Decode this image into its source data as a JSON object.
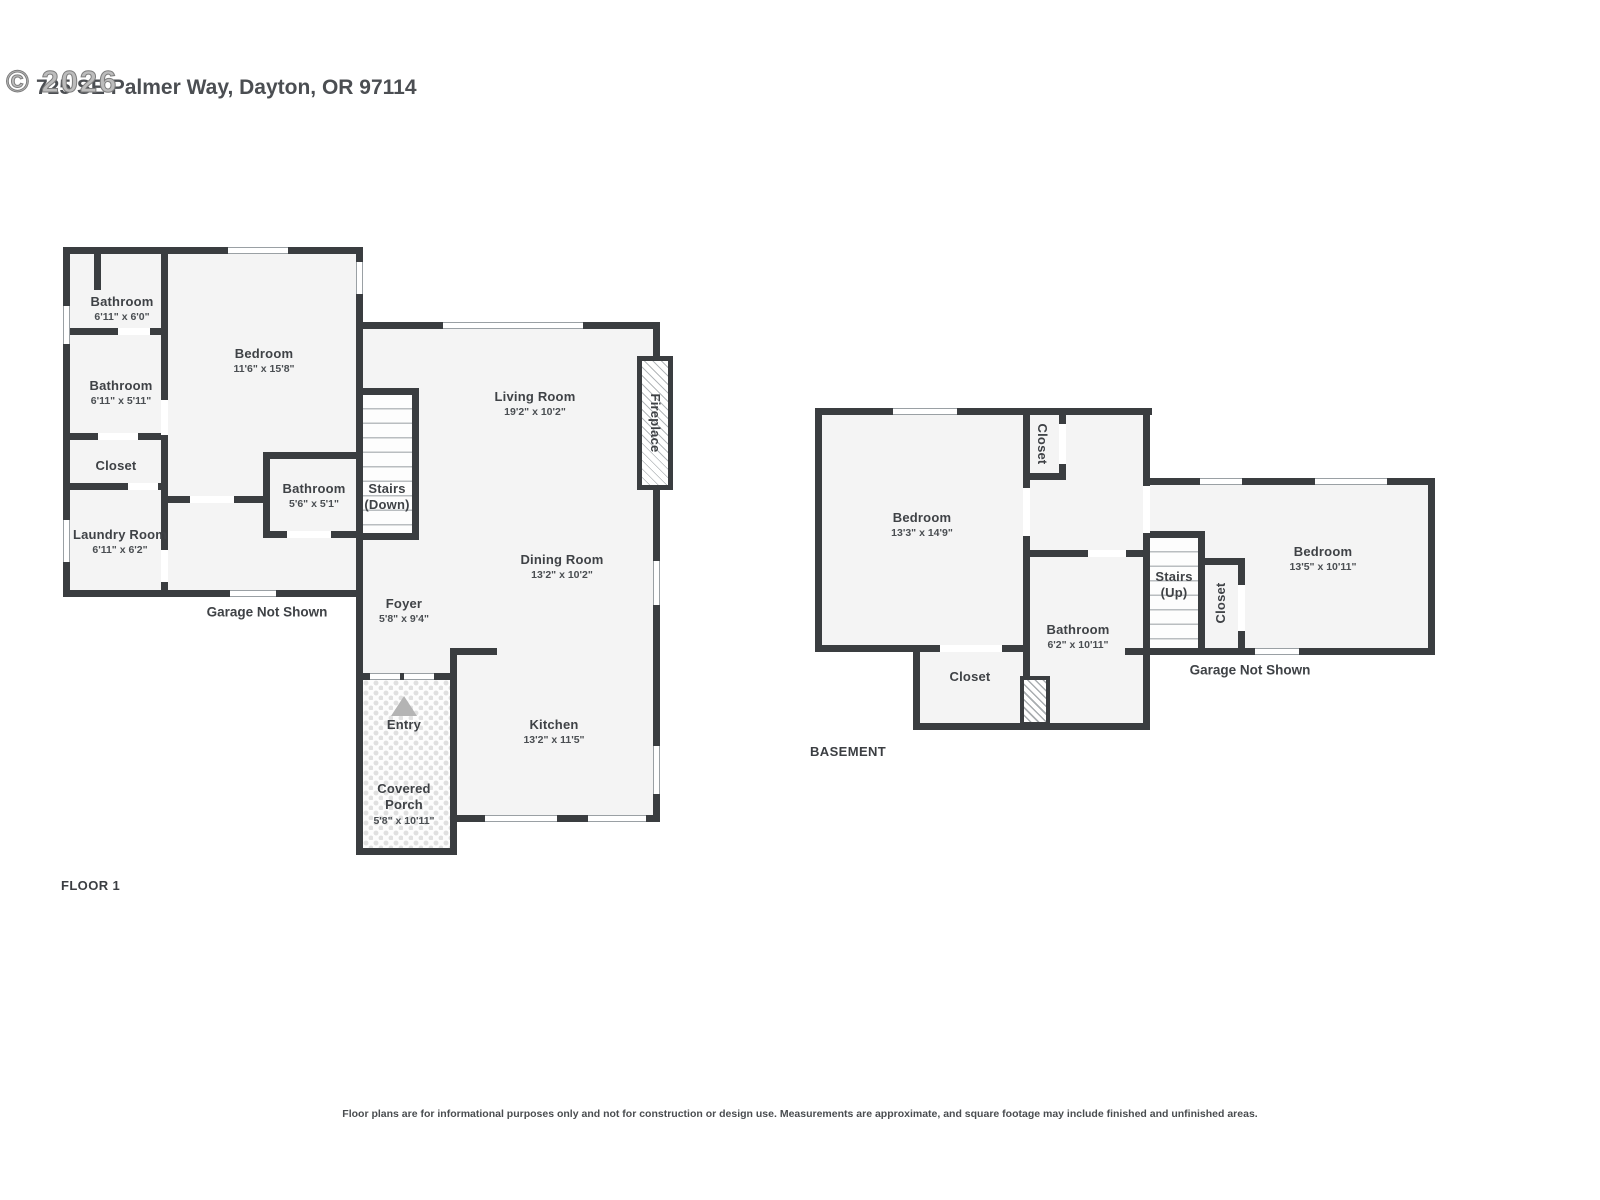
{
  "meta": {
    "colors": {
      "wall": "#3a3d40",
      "room_fill": "#f4f4f4",
      "text": "#3f4246",
      "watermark": "#8f8f8f",
      "entry_arrow": "#b4b4b4"
    }
  },
  "header": {
    "watermark": "© 2026",
    "address": "725 SE Palmer Way, Dayton, OR 97114"
  },
  "floor1": {
    "floor_label": "FLOOR 1",
    "garage_note": "Garage Not Shown",
    "rooms": {
      "bathroom_a": {
        "name": "Bathroom",
        "dims": "6'11\" x 6'0\""
      },
      "bathroom_b": {
        "name": "Bathroom",
        "dims": "6'11\" x 5'11\""
      },
      "closet": {
        "name": "Closet"
      },
      "laundry": {
        "name": "Laundry Room",
        "dims": "6'11\" x 6'2\""
      },
      "bedroom": {
        "name": "Bedroom",
        "dims": "11'6\" x 15'8\""
      },
      "bathroom_c": {
        "name": "Bathroom",
        "dims": "5'6\" x 5'1\""
      },
      "stairs": {
        "name": "Stairs",
        "sub": "(Down)"
      },
      "living_room": {
        "name": "Living Room",
        "dims": "19'2\" x 10'2\""
      },
      "dining_room": {
        "name": "Dining Room",
        "dims": "13'2\" x 10'2\""
      },
      "foyer": {
        "name": "Foyer",
        "dims": "5'8\" x 9'4\""
      },
      "kitchen": {
        "name": "Kitchen",
        "dims": "13'2\" x 11'5\""
      },
      "entry": {
        "name": "Entry"
      },
      "covered_porch": {
        "name": "Covered Porch",
        "dims": "5'8\" x 10'11\""
      },
      "fireplace": {
        "name": "Fireplace"
      }
    }
  },
  "basement": {
    "floor_label": "BASEMENT",
    "garage_note": "Garage Not Shown",
    "rooms": {
      "bedroom_a": {
        "name": "Bedroom",
        "dims": "13'3\" x 14'9\""
      },
      "closet_top": {
        "name": "Closet"
      },
      "bathroom": {
        "name": "Bathroom",
        "dims": "6'2\" x 10'11\""
      },
      "closet_bottom": {
        "name": "Closet"
      },
      "stairs": {
        "name": "Stairs",
        "sub": "(Up)"
      },
      "closet_mid": {
        "name": "Closet"
      },
      "bedroom_b": {
        "name": "Bedroom",
        "dims": "13'5\" x 10'11\""
      }
    }
  },
  "footer": {
    "disclaimer": "Floor plans are for informational purposes only and not for construction or design use. Measurements are approximate, and square footage may include finished and unfinished areas."
  }
}
